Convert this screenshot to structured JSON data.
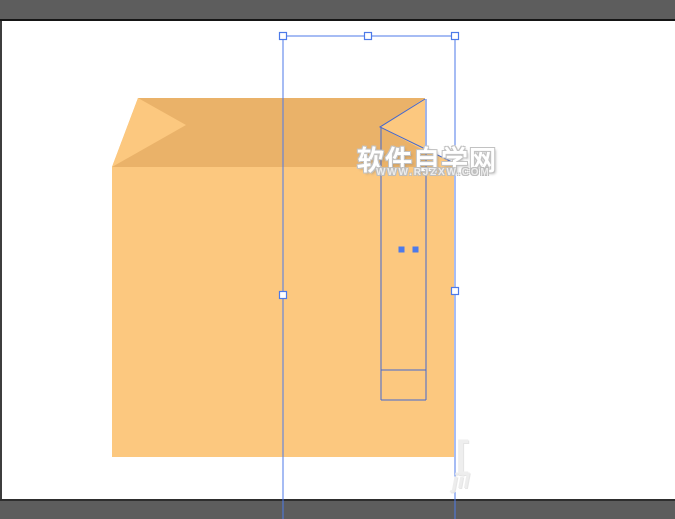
{
  "window": {
    "description": "vector drawing app canvas with selected orange box artwork",
    "colors": {
      "chrome_gray": "#5d5d5d",
      "top_divider": "#151515",
      "bottom_divider": "#2e2e2e",
      "left_edge": "#3d3d3d",
      "canvas": "#ffffff"
    }
  },
  "watermark": {
    "title": "软件自学网",
    "url": "WWW.RJZXW.COM",
    "faint_fragments": {
      "bracket": "[",
      "script": "jìl"
    }
  },
  "artwork": {
    "description": "orange paper box with folded top flaps",
    "colors": {
      "face_light": "#FCC87F",
      "face_dark": "#EAB269"
    }
  },
  "selection": {
    "colors": {
      "bounding_box": "#4d7ae9",
      "path": "#4368cf",
      "handle_fill": "#ffffff",
      "anchor_fill": "#4d7ae9"
    }
  }
}
